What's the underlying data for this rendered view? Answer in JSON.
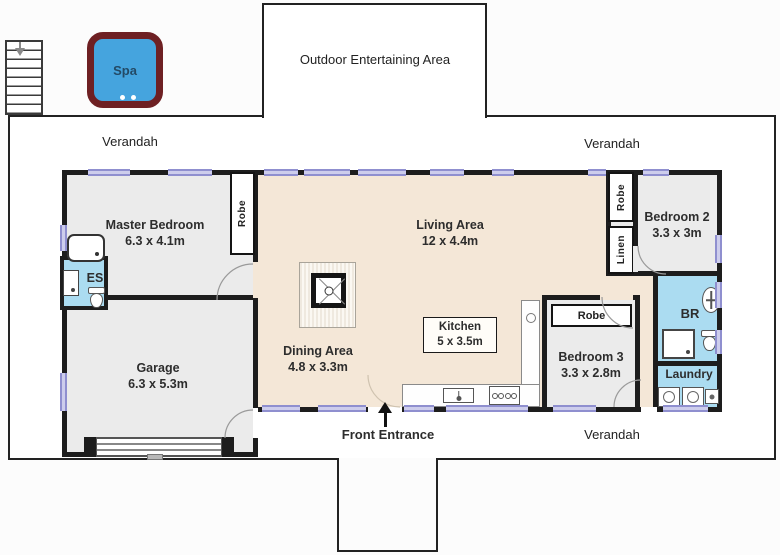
{
  "plan": {
    "outdoor_label": "Outdoor Entertaining Area",
    "verandah_top_left": "Verandah",
    "verandah_top_right": "Verandah",
    "verandah_bottom": "Verandah",
    "front_entrance_label": "Front Entrance",
    "spa_label": "Spa"
  },
  "rooms": {
    "master_bedroom": {
      "name": "Master Bedroom",
      "dims": "6.3 x 4.1m"
    },
    "garage": {
      "name": "Garage",
      "dims": "6.3 x 5.3m"
    },
    "living_area": {
      "name": "Living Area",
      "dims": "12 x 4.4m"
    },
    "dining_area": {
      "name": "Dining Area",
      "dims": "4.8 x 3.3m"
    },
    "kitchen": {
      "name": "Kitchen",
      "dims": "5 x 3.5m"
    },
    "bedroom2": {
      "name": "Bedroom 2",
      "dims": "3.3 x 3m"
    },
    "bedroom3": {
      "name": "Bedroom 3",
      "dims": "3.3 x 2.8m"
    },
    "ensuite_label": "ES",
    "bathroom_label": "BR",
    "laundry_label": "Laundry"
  },
  "storage": {
    "master_robe": "Robe",
    "bedroom2_robe": "Robe",
    "linen": "Linen",
    "bedroom3_robe": "Robe"
  },
  "colors": {
    "wall": "#1d1d1d",
    "living_floor": "#f4e7d7",
    "room_floor": "#ebebeb",
    "wet_floor": "#abdcf1",
    "window": "#8f8fcf",
    "spa_water": "#45a4de",
    "spa_shell": "#6e2023"
  }
}
